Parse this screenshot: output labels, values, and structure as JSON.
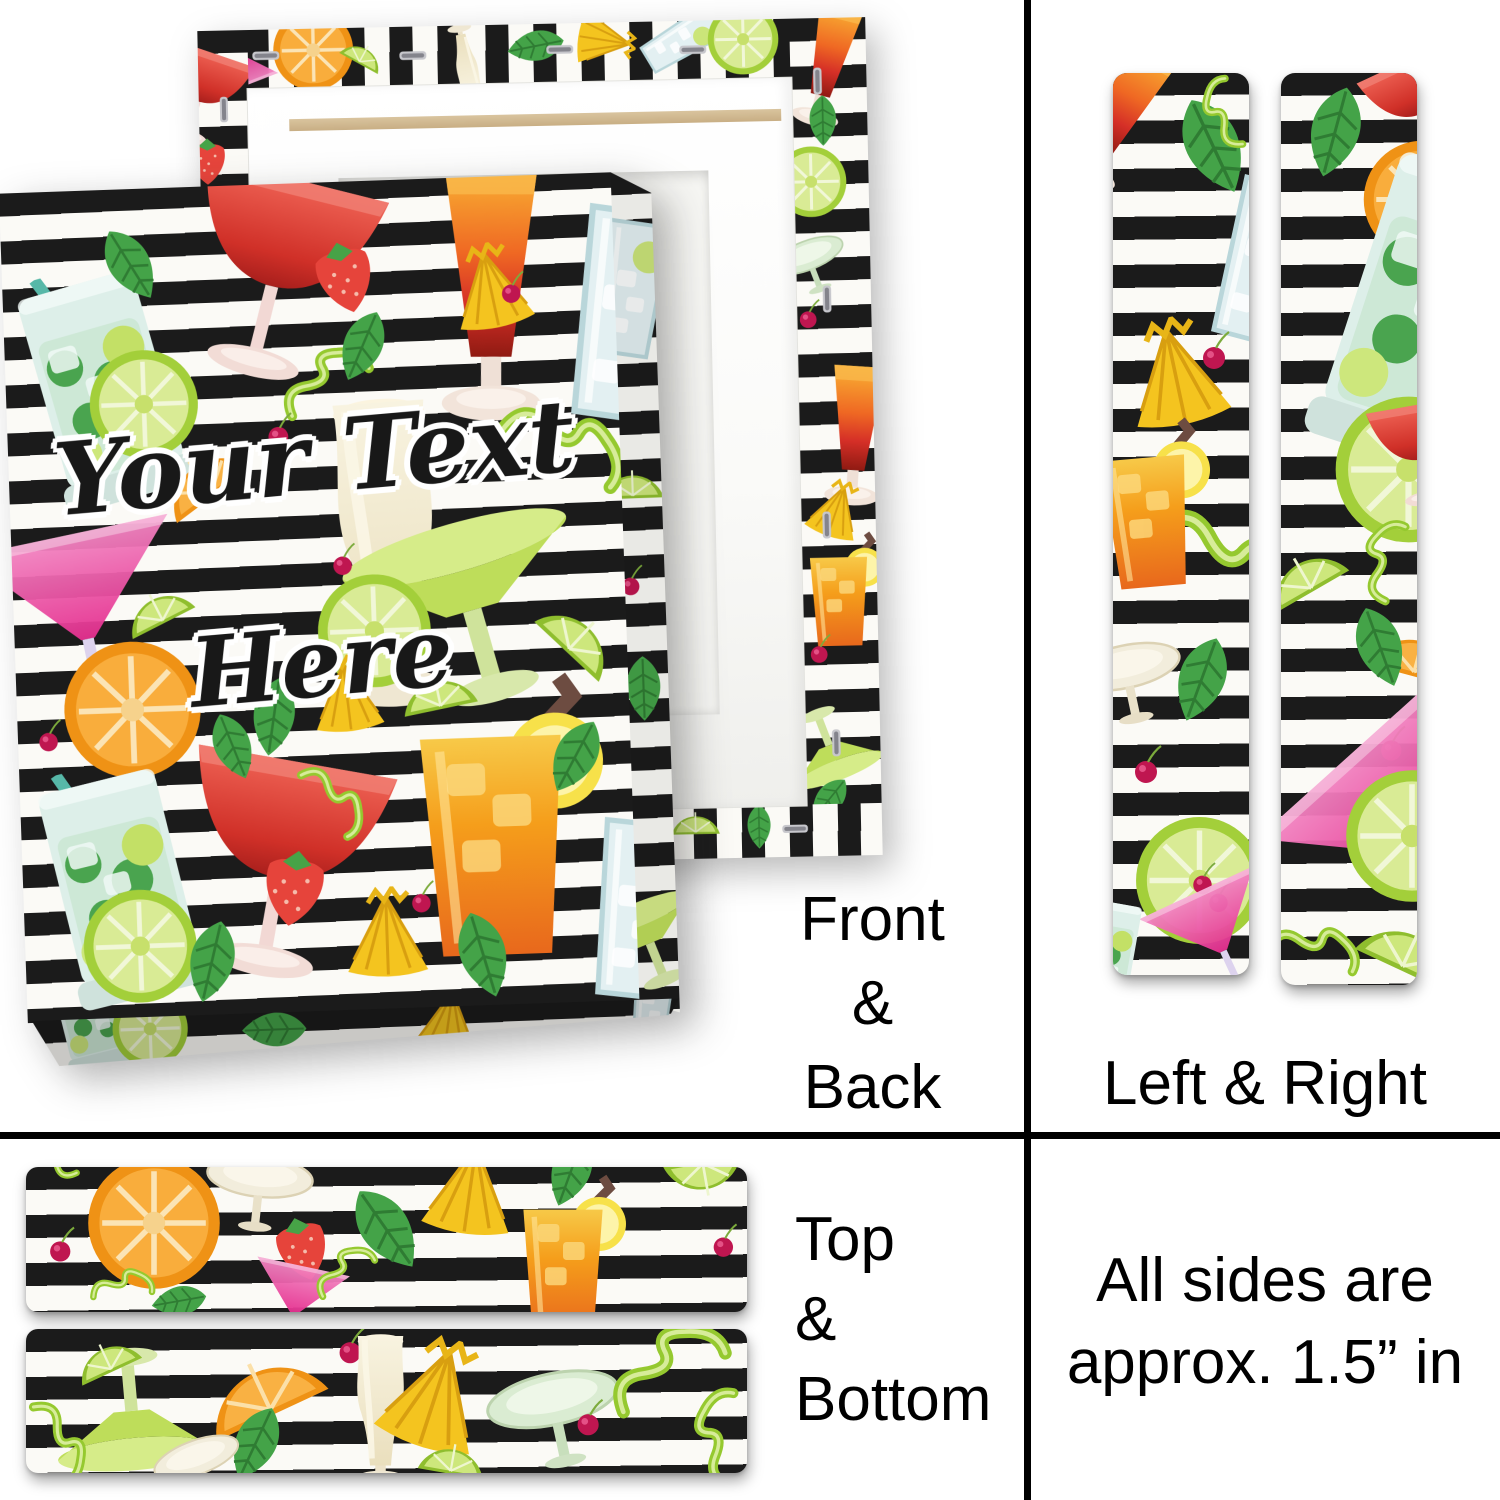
{
  "personalization": {
    "line1": "Your Text",
    "line2": "Here"
  },
  "views": {
    "front_back": {
      "label_lines": [
        "Front",
        "&",
        "Back"
      ]
    },
    "left_right": {
      "label": "Left & Right"
    },
    "top_bottom": {
      "label_lines": [
        "Top",
        "&",
        "Bottom"
      ]
    },
    "note": {
      "lines": [
        "All sides are",
        "approx. 1.5” in"
      ]
    }
  },
  "colors": {
    "divider": "#000000",
    "label_text": "#000000",
    "stripe_black": "#1b1b1b",
    "stripe_white": "#fbfaf6",
    "stretcher_frame_white": "#ffffff",
    "back_recess": "#f6f6f3",
    "wood_bar": "#d3bc96",
    "lime_green": "#a3cf3a",
    "orange": "#f39a1d",
    "strawberry_red": "#e6443b",
    "cocktail_pink": "#e52f8f",
    "sunrise_orange_red": "#ef6823",
    "mint_green": "#44a348",
    "pineapple_yellow": "#f4c41f",
    "cherry_red": "#bf1650"
  },
  "pattern": {
    "name": "cocktails on black and white brush stripes",
    "surfaces": {
      "front_face": [
        {
          "icon": "mojito",
          "x": -5,
          "y": 9,
          "s": 260,
          "r": -14
        },
        {
          "icon": "daiquiri",
          "x": 23,
          "y": -4,
          "s": 260,
          "r": 16
        },
        {
          "icon": "mint",
          "x": 14,
          "y": 4,
          "s": 85,
          "r": -30
        },
        {
          "icon": "strawberry",
          "x": 49,
          "y": 6,
          "s": 85,
          "r": -12
        },
        {
          "icon": "sunrise",
          "x": 56,
          "y": -2,
          "s": 290,
          "r": 2
        },
        {
          "icon": "clear-glass",
          "x": 81,
          "y": 3,
          "s": 250,
          "r": 10
        },
        {
          "icon": "lime-slice",
          "x": 13,
          "y": 19,
          "s": 115,
          "r": 0
        },
        {
          "icon": "orange-wedge",
          "x": 23,
          "y": 29,
          "s": 105,
          "r": -35
        },
        {
          "icon": "peel",
          "x": 45,
          "y": 19,
          "s": 100,
          "r": 15
        },
        {
          "icon": "cherry",
          "x": 41,
          "y": 27,
          "s": 45,
          "r": 0
        },
        {
          "icon": "pineapple",
          "x": 72,
          "y": 8,
          "s": 95,
          "r": -10
        },
        {
          "icon": "cherry",
          "x": 80,
          "y": 11,
          "s": 42,
          "r": 0
        },
        {
          "icon": "mint",
          "x": 52,
          "y": 15,
          "s": 80,
          "r": 25
        },
        {
          "icon": "pina",
          "x": 33,
          "y": 25,
          "s": 350,
          "r": -2
        },
        {
          "icon": "peel",
          "x": 79,
          "y": 26,
          "s": 135,
          "r": 75
        },
        {
          "icon": "martini",
          "x": -7,
          "y": 39,
          "s": 230,
          "r": -10
        },
        {
          "icon": "lime-wedge",
          "x": 17,
          "y": 46,
          "s": 80,
          "r": -25
        },
        {
          "icon": "margarita",
          "x": 54,
          "y": 39,
          "s": 270,
          "r": -14
        },
        {
          "icon": "lime-slice",
          "x": 49,
          "y": 47,
          "s": 120,
          "r": 0
        },
        {
          "icon": "cherry",
          "x": 51,
          "y": 43,
          "s": 42,
          "r": 0
        },
        {
          "icon": "lime-wedge",
          "x": 84,
          "y": 50,
          "s": 100,
          "r": 45
        },
        {
          "icon": "lime-wedge",
          "x": 62,
          "y": 57,
          "s": 85,
          "r": -10
        },
        {
          "icon": "orange-slice",
          "x": 7,
          "y": 54,
          "s": 145,
          "r": 0
        },
        {
          "icon": "cherry",
          "x": 2,
          "y": 63,
          "s": 42,
          "r": 0
        },
        {
          "icon": "mint",
          "x": 35,
          "y": 59,
          "s": 85,
          "r": 10
        },
        {
          "icon": "pineapple",
          "x": 47,
          "y": 57,
          "s": 85,
          "r": -5
        },
        {
          "icon": "daiquiri",
          "x": 19,
          "y": 66,
          "s": 280,
          "r": 12
        },
        {
          "icon": "rum",
          "x": 51,
          "y": 59,
          "s": 320,
          "r": 0
        },
        {
          "icon": "mint",
          "x": 29,
          "y": 63,
          "s": 75,
          "r": -20
        },
        {
          "icon": "peel",
          "x": 43,
          "y": 70,
          "s": 85,
          "r": 100
        },
        {
          "icon": "strawberry",
          "x": 37,
          "y": 79,
          "s": 90,
          "r": 10
        },
        {
          "icon": "mojito",
          "x": -5,
          "y": 69,
          "s": 260,
          "r": -12
        },
        {
          "icon": "lime-slice",
          "x": 9,
          "y": 84,
          "s": 120,
          "r": 0
        },
        {
          "icon": "mint",
          "x": 23,
          "y": 88,
          "s": 90,
          "r": 15
        },
        {
          "icon": "pineapple",
          "x": 51,
          "y": 85,
          "s": 100,
          "r": 0
        },
        {
          "icon": "cherry",
          "x": 62,
          "y": 84,
          "s": 42,
          "r": 0
        },
        {
          "icon": "mint",
          "x": 67,
          "y": 88,
          "s": 95,
          "r": -15
        },
        {
          "icon": "clear-glass",
          "x": 83,
          "y": 77,
          "s": 210,
          "r": 8
        },
        {
          "icon": "mint",
          "x": 84,
          "y": 65,
          "s": 85,
          "r": 30
        }
      ],
      "front_side": [
        {
          "icon": "clear-glass",
          "x": -160,
          "y": 5,
          "s": 160,
          "r": 10
        },
        {
          "icon": "lime-wedge",
          "x": -60,
          "y": 33,
          "s": 70,
          "r": 0
        },
        {
          "icon": "cherry",
          "x": -30,
          "y": 46,
          "s": 40,
          "r": 0
        },
        {
          "icon": "mint",
          "x": -50,
          "y": 57,
          "s": 70,
          "r": 0
        },
        {
          "icon": "margarita",
          "x": -120,
          "y": 85,
          "s": 130,
          "r": -20
        }
      ],
      "front_bottom": [
        {
          "icon": "mojito",
          "x": -1,
          "y": -150,
          "s": 130,
          "r": -12
        },
        {
          "icon": "lime-slice",
          "x": 12,
          "y": -60,
          "s": 80,
          "r": 0
        },
        {
          "icon": "mint",
          "x": 32,
          "y": -40,
          "s": 70,
          "r": 90
        },
        {
          "icon": "pineapple",
          "x": 58,
          "y": -50,
          "s": 80,
          "r": 10
        },
        {
          "icon": "clear-glass",
          "x": 88,
          "y": -90,
          "s": 100,
          "r": 8
        }
      ],
      "back_top": [
        {
          "icon": "martini",
          "x": 0,
          "y": -20,
          "s": 75,
          "r": 160
        },
        {
          "icon": "orange-slice",
          "x": 11,
          "y": -35,
          "s": 85,
          "r": 0
        },
        {
          "icon": "lime-wedge",
          "x": 21,
          "y": 5,
          "s": 50,
          "r": 30
        },
        {
          "icon": "pina",
          "x": 34,
          "y": -15,
          "s": 80,
          "r": 170
        },
        {
          "icon": "mint",
          "x": 46,
          "y": -15,
          "s": 62,
          "r": 80
        },
        {
          "icon": "pineapple",
          "x": 56,
          "y": -25,
          "s": 65,
          "r": 100
        },
        {
          "icon": "clear-glass",
          "x": 65,
          "y": -45,
          "s": 95,
          "r": 60
        },
        {
          "icon": "lime-slice",
          "x": 76,
          "y": -30,
          "s": 75,
          "r": 0
        },
        {
          "icon": "staple",
          "x": 7,
          "y": 8,
          "s": 42,
          "r": 90
        },
        {
          "icon": "staple",
          "x": 29,
          "y": 14,
          "s": 42,
          "r": 90
        },
        {
          "icon": "staple",
          "x": 51,
          "y": 8,
          "s": 42,
          "r": 90
        },
        {
          "icon": "staple",
          "x": 71,
          "y": 14,
          "s": 42,
          "r": 90
        },
        {
          "icon": "staple",
          "x": 89,
          "y": 8,
          "s": 42,
          "r": 90
        }
      ],
      "back_right": [
        {
          "icon": "sunrise",
          "x": -45,
          "y": -2,
          "s": 140,
          "r": 15
        },
        {
          "icon": "mint",
          "x": 5,
          "y": 9,
          "s": 55,
          "r": 0
        },
        {
          "icon": "lime-slice",
          "x": -25,
          "y": 15,
          "s": 75,
          "r": 0
        },
        {
          "icon": "coupe-green",
          "x": -35,
          "y": 24,
          "s": 85,
          "r": -20
        },
        {
          "icon": "cherry",
          "x": -5,
          "y": 33,
          "s": 38,
          "r": 0
        },
        {
          "icon": "sunrise",
          "x": -30,
          "y": 41,
          "s": 160,
          "r": 5
        },
        {
          "icon": "pineapple",
          "x": 5,
          "y": 55,
          "s": 65,
          "r": 20
        },
        {
          "icon": "rum",
          "x": -35,
          "y": 61,
          "s": 130,
          "r": 0
        },
        {
          "icon": "cherry",
          "x": 0,
          "y": 73,
          "s": 38,
          "r": 0
        },
        {
          "icon": "margarita",
          "x": -45,
          "y": 79,
          "s": 110,
          "r": 160
        },
        {
          "icon": "mint",
          "x": -5,
          "y": 90,
          "s": 55,
          "r": 40
        },
        {
          "icon": "staple",
          "x": 8,
          "y": 5,
          "s": 42,
          "r": 0
        },
        {
          "icon": "staple",
          "x": 14,
          "y": 31,
          "s": 42,
          "r": 0
        },
        {
          "icon": "staple",
          "x": 8,
          "y": 58,
          "s": 42,
          "r": 0
        },
        {
          "icon": "staple",
          "x": 14,
          "y": 84,
          "s": 42,
          "r": 0
        }
      ],
      "back_left": [
        {
          "icon": "daiquiri",
          "x": -120,
          "y": 1,
          "s": 120,
          "r": 20
        },
        {
          "icon": "strawberry",
          "x": -40,
          "y": 12,
          "s": 55,
          "r": 0
        },
        {
          "icon": "lime-slice",
          "x": -60,
          "y": 22,
          "s": 70,
          "r": 0
        },
        {
          "icon": "staple",
          "x": 10,
          "y": 7,
          "s": 40,
          "r": 0
        },
        {
          "icon": "staple",
          "x": 10,
          "y": 38,
          "s": 40,
          "r": 0
        }
      ],
      "back_bottom": [
        {
          "icon": "lime-wedge",
          "x": 68,
          "y": -20,
          "s": 55,
          "r": 0
        },
        {
          "icon": "mint",
          "x": 78,
          "y": -5,
          "s": 48,
          "r": 0
        },
        {
          "icon": "staple",
          "x": 62,
          "y": 8,
          "s": 40,
          "r": 90
        },
        {
          "icon": "staple",
          "x": 84,
          "y": 8,
          "s": 40,
          "r": 90
        }
      ],
      "left_strip": [
        {
          "icon": "sunrise",
          "x": -60,
          "y": -4,
          "s": 170,
          "r": 28
        },
        {
          "icon": "mint",
          "x": 33,
          "y": 2,
          "s": 110,
          "r": -25
        },
        {
          "icon": "peel",
          "x": 60,
          "y": 0,
          "s": 75,
          "r": -60
        },
        {
          "icon": "clear-glass",
          "x": 38,
          "y": 11,
          "s": 190,
          "r": 15
        },
        {
          "icon": "pineapple",
          "x": 2,
          "y": 27,
          "s": 120,
          "r": -12
        },
        {
          "icon": "cherry",
          "x": 58,
          "y": 28,
          "s": 50,
          "r": 0
        },
        {
          "icon": "coupe-top",
          "x": -50,
          "y": 42,
          "s": 115,
          "r": 8
        },
        {
          "icon": "peel",
          "x": 16,
          "y": 47,
          "s": 160,
          "r": 85
        },
        {
          "icon": "rum",
          "x": -45,
          "y": 38,
          "s": 190,
          "r": -5
        },
        {
          "icon": "coupe-top",
          "x": -35,
          "y": 60,
          "s": 125,
          "r": -12
        },
        {
          "icon": "mint",
          "x": 30,
          "y": 62,
          "s": 95,
          "r": 20
        },
        {
          "icon": "cherry",
          "x": 8,
          "y": 74,
          "s": 50,
          "r": 0
        },
        {
          "icon": "lime-slice",
          "x": 14,
          "y": 82,
          "s": 135,
          "r": 0
        },
        {
          "icon": "cherry",
          "x": 52,
          "y": 87,
          "s": 42,
          "r": 0
        },
        {
          "icon": "cherry",
          "x": 64,
          "y": 89,
          "s": 42,
          "r": 0
        },
        {
          "icon": "martini",
          "x": 28,
          "y": 89,
          "s": 140,
          "r": -25
        },
        {
          "icon": "mojito",
          "x": -55,
          "y": 91,
          "s": 130,
          "r": 10
        }
      ],
      "right_strip": [
        {
          "icon": "mint",
          "x": 3,
          "y": 1,
          "s": 100,
          "r": 15
        },
        {
          "icon": "daiquiri",
          "x": 55,
          "y": -3,
          "s": 130,
          "r": -25
        },
        {
          "icon": "orange-slice",
          "x": 58,
          "y": 7,
          "s": 125,
          "r": 0
        },
        {
          "icon": "mojito",
          "x": -18,
          "y": 8,
          "s": 350,
          "r": 18
        },
        {
          "icon": "lime-slice",
          "x": 37,
          "y": 35,
          "s": 155,
          "r": 0
        },
        {
          "icon": "lime-wedge",
          "x": -18,
          "y": 50,
          "s": 95,
          "r": -30
        },
        {
          "icon": "orange-wedge",
          "x": 60,
          "y": 58,
          "s": 110,
          "r": 15
        },
        {
          "icon": "peel",
          "x": 52,
          "y": 49,
          "s": 85,
          "r": -30
        },
        {
          "icon": "daiquiri",
          "x": 55,
          "y": 35,
          "s": 130,
          "r": -10
        },
        {
          "icon": "mint",
          "x": 40,
          "y": 58,
          "s": 90,
          "r": -20
        },
        {
          "icon": "cherry",
          "x": 66,
          "y": 71,
          "s": 46,
          "r": 0
        },
        {
          "icon": "martini",
          "x": 6,
          "y": 69,
          "s": 280,
          "r": -42
        },
        {
          "icon": "lime-slice",
          "x": 45,
          "y": 76,
          "s": 140,
          "r": 0
        },
        {
          "icon": "lime-wedge",
          "x": 52,
          "y": 90,
          "s": 115,
          "r": 25
        },
        {
          "icon": "peel",
          "x": -12,
          "y": 92,
          "s": 95,
          "r": 60
        }
      ],
      "top_strip": [
        {
          "icon": "cherry",
          "x": 2,
          "y": 38,
          "s": 46,
          "r": 0
        },
        {
          "icon": "peel",
          "x": 0,
          "y": -35,
          "s": 65,
          "r": -80
        },
        {
          "icon": "orange-slice",
          "x": 8,
          "y": -10,
          "s": 140,
          "r": 0
        },
        {
          "icon": "coupe-top",
          "x": 24,
          "y": -28,
          "s": 120,
          "r": 6
        },
        {
          "icon": "strawberry",
          "x": 33,
          "y": 28,
          "s": 76,
          "r": -15
        },
        {
          "icon": "martini",
          "x": 30,
          "y": 62,
          "s": 105,
          "r": 12
        },
        {
          "icon": "peel",
          "x": 40,
          "y": 52,
          "s": 70,
          "r": 10
        },
        {
          "icon": "mint",
          "x": 43,
          "y": 8,
          "s": 100,
          "r": -35
        },
        {
          "icon": "pineapple",
          "x": 54,
          "y": -22,
          "s": 110,
          "r": 8
        },
        {
          "icon": "mint",
          "x": 70,
          "y": -25,
          "s": 80,
          "r": 20
        },
        {
          "icon": "rum",
          "x": 62,
          "y": 2,
          "s": 180,
          "r": 0
        },
        {
          "icon": "lime-wedge",
          "x": 88,
          "y": -25,
          "s": 90,
          "r": 170
        },
        {
          "icon": "cherry",
          "x": 94,
          "y": 36,
          "s": 44,
          "r": 0
        },
        {
          "icon": "peel",
          "x": 9,
          "y": 65,
          "s": 65,
          "r": 40
        },
        {
          "icon": "mint",
          "x": 17,
          "y": 72,
          "s": 60,
          "r": 80
        }
      ],
      "bottom_strip": [
        {
          "icon": "margarita",
          "x": 2,
          "y": -18,
          "s": 180,
          "r": 175
        },
        {
          "icon": "lime-wedge",
          "x": 6,
          "y": -5,
          "s": 75,
          "r": -25
        },
        {
          "icon": "peel",
          "x": -3,
          "y": 50,
          "s": 90,
          "r": 115
        },
        {
          "icon": "orange-wedge",
          "x": 23,
          "y": -5,
          "s": 140,
          "r": -25
        },
        {
          "icon": "cherry",
          "x": 42,
          "y": -5,
          "s": 48,
          "r": 0
        },
        {
          "icon": "mint",
          "x": 26,
          "y": 50,
          "s": 85,
          "r": 25
        },
        {
          "icon": "coupe-top",
          "x": 17,
          "y": 60,
          "s": 100,
          "r": -20
        },
        {
          "icon": "pina",
          "x": 37,
          "y": 0,
          "s": 175,
          "r": 0
        },
        {
          "icon": "pineapple",
          "x": 48,
          "y": 5,
          "s": 125,
          "r": 18
        },
        {
          "icon": "lime-wedge",
          "x": 54,
          "y": 65,
          "s": 75,
          "r": 10
        },
        {
          "icon": "coupe-green",
          "x": 63,
          "y": 5,
          "s": 150,
          "r": -12
        },
        {
          "icon": "cherry",
          "x": 75,
          "y": 45,
          "s": 48,
          "r": 0
        },
        {
          "icon": "peel",
          "x": 81,
          "y": -10,
          "s": 130,
          "r": 15
        },
        {
          "icon": "peel",
          "x": 91,
          "y": 40,
          "s": 100,
          "r": -45
        }
      ]
    }
  }
}
